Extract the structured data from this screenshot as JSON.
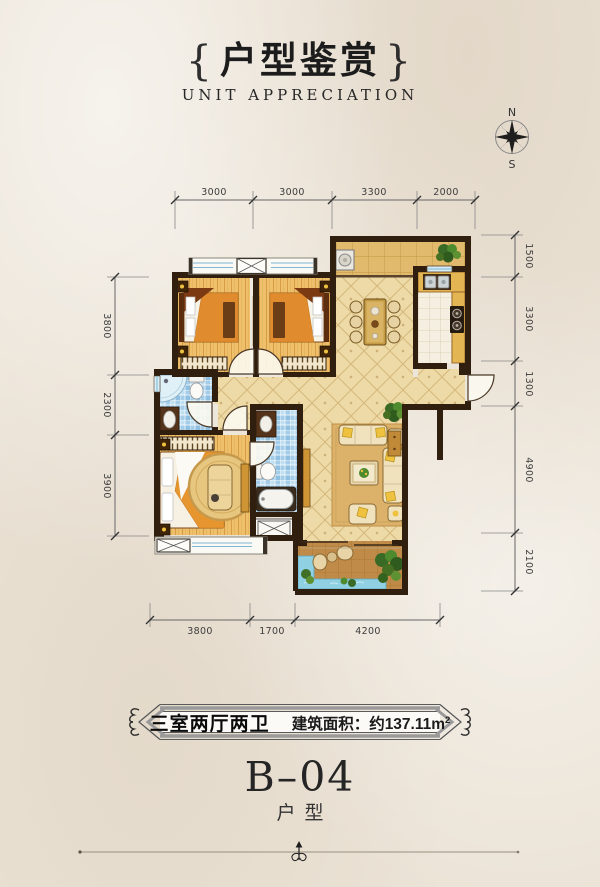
{
  "header": {
    "brace_left": "{",
    "title": "户型鉴赏",
    "brace_right": "}",
    "subtitle": "UNIT APPRECIATION"
  },
  "compass": {
    "north": "N",
    "south": "S"
  },
  "dimensions": {
    "top": [
      "3000",
      "3000",
      "3300",
      "2000"
    ],
    "right": [
      "1500",
      "3300",
      "1300",
      "4900",
      "2100"
    ],
    "left": [
      "3800",
      "2300",
      "3900"
    ],
    "bottom": [
      "3800",
      "1700",
      "4200"
    ]
  },
  "banner": {
    "rooms_label": "三室两厅两卫",
    "area_label": "建筑面积：约137.11m",
    "area_superscript": "2"
  },
  "unit": {
    "code": "B–04",
    "type_label": "户型"
  },
  "colors": {
    "wall": "#301e0e",
    "floor_tile": "#eedaa6",
    "wood_floor": "#efc06c",
    "bath_tile": "#a3cde9",
    "accent_gold": "#eec23f",
    "water": "#8fd0e2"
  }
}
